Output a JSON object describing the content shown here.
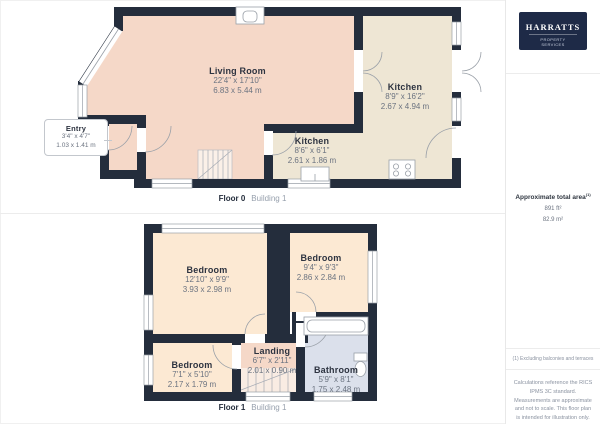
{
  "brand": {
    "name": "HARRATTS",
    "tagline": "PROPERTY SERVICES"
  },
  "floor0": {
    "caption": "Floor 0",
    "building": "Building 1",
    "rooms": {
      "living": {
        "name": "Living Room",
        "imperial": "22'4\" x 17'10\"",
        "metric": "6.83 x 5.44 m"
      },
      "kitchen_small": {
        "name": "Kitchen",
        "imperial": "8'6\" x 6'1\"",
        "metric": "2.61 x 1.86 m"
      },
      "kitchen_main": {
        "name": "Kitchen",
        "imperial": "8'9\" x 16'2\"",
        "metric": "2.67 x 4.94 m"
      },
      "entry": {
        "name": "Entry",
        "imperial": "3'4\" x 4'7\"",
        "metric": "1.03 x 1.41 m"
      }
    }
  },
  "floor1": {
    "caption": "Floor 1",
    "building": "Building 1",
    "rooms": {
      "bedroom_main": {
        "name": "Bedroom",
        "imperial": "12'10\" x 9'9\"",
        "metric": "3.93 x 2.98 m"
      },
      "bedroom_second": {
        "name": "Bedroom",
        "imperial": "9'4\" x 9'3\"",
        "metric": "2.86 x 2.84 m"
      },
      "bedroom_third": {
        "name": "Bedroom",
        "imperial": "7'1\" x 5'10\"",
        "metric": "2.17 x 1.79 m"
      },
      "landing": {
        "name": "Landing",
        "imperial": "6'7\" x 2'11\"",
        "metric": "2.01 x 0.90 m"
      },
      "bathroom": {
        "name": "Bathroom",
        "imperial": "5'9\" x 8'1\"",
        "metric": "1.75 x 2.48 m"
      }
    }
  },
  "sidebar": {
    "total_area_label": "Approximate total area",
    "total_area_ref": "(1)",
    "total_area_imperial": "891 ft²",
    "total_area_metric": "82.9 m²",
    "footnote": "(1) Excluding balconies and terraces",
    "disclaimer": "Calculations reference the RICS IPMS 3C standard. Measurements are approximate and not to scale. This floor plan is intended for illustration only.",
    "credit_brand": "GIRAFFE",
    "credit_suffix": "360"
  },
  "colors": {
    "wall": "#242d3c",
    "living": "#f5d8c8",
    "kitchen": "#eee6d4",
    "bedroom": "#fce9d3",
    "bathroom": "#dbe0eb",
    "logo_bg": "#1e2a47"
  }
}
